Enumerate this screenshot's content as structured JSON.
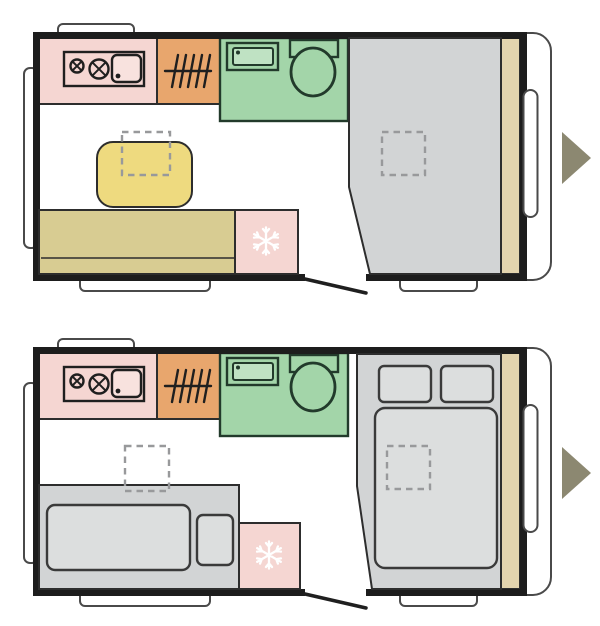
{
  "image_type": "caravan-floorplan-pair",
  "colors": {
    "background": "#ffffff",
    "floor": "#ffffff",
    "wall": "#1d1d1d",
    "outline": "#2d2d2d",
    "exterior_outline": "#4a4a4a",
    "fixture": "#1f1f1f",
    "kitchen_counter": "#f5d6d2",
    "sink_basin": "#f8e2de",
    "wardrobe": "#e8a66d",
    "bathroom": "#a3d5a9",
    "bathroom_fixture_outline": "#223a2b",
    "bathroom_sink_inner": "#bfe2c3",
    "table": "#eeda7f",
    "bench": "#d8cc92",
    "fridge": "#f5d6d2",
    "snowflake": "#ffffff",
    "bed_base": "#d2d4d5",
    "bedding": "#dcdede",
    "bedding_outline": "#3a3a3a",
    "front_shelf": "#e3d4ae",
    "vent_dash": "#98999b",
    "door": "#1f1f1f",
    "arrow": "#8c8871"
  },
  "plans": [
    {
      "name": "day-layout",
      "elements": [
        "kitchen-hob-sink",
        "wardrobe-rail",
        "bathroom-washbasin",
        "bathroom-toilet",
        "dinette-table",
        "bench-seat",
        "refrigerator-snowflake",
        "bed-area",
        "roof-vent-over-table",
        "roof-vent-over-bed",
        "entry-door",
        "front-window",
        "direction-arrow"
      ]
    },
    {
      "name": "night-layout",
      "elements": [
        "kitchen-hob-sink",
        "wardrobe-rail",
        "bathroom-washbasin",
        "bathroom-toilet",
        "single-bed-mattress",
        "seat-cushion",
        "refrigerator-snowflake",
        "double-bed",
        "pillow-left",
        "pillow-right",
        "duvet",
        "roof-vent-living",
        "roof-vent-over-bed",
        "entry-door",
        "front-window",
        "direction-arrow"
      ]
    }
  ]
}
